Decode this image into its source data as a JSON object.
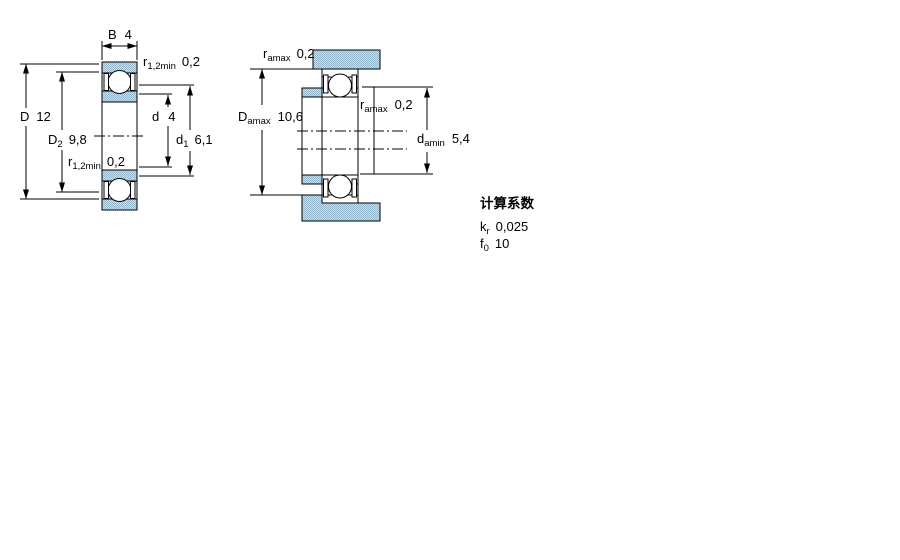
{
  "page": {
    "background": "#ffffff"
  },
  "colors": {
    "line": "#000000",
    "stipple_dark": "#8fb4cc",
    "stipple_light": "#cfe0ec"
  },
  "left_drawing": {
    "description": "bearing-cross-section-with-boundary-dimensions",
    "dims": {
      "B": {
        "symbol": "B",
        "value": "4"
      },
      "r_top": {
        "symbol": "r",
        "sub": "1,2min",
        "value": "0,2"
      },
      "D": {
        "symbol": "D",
        "value": "12"
      },
      "D2": {
        "symbol": "D",
        "sub": "2",
        "value": "9,8"
      },
      "r_mid": {
        "symbol": "r",
        "sub": "1,2min",
        "value": "0,2"
      },
      "d": {
        "symbol": "d",
        "value": "4"
      },
      "d1": {
        "symbol": "d",
        "sub": "1",
        "value": "6,1"
      }
    }
  },
  "right_drawing": {
    "description": "bearing-mounted-abutment-dimensions",
    "dims": {
      "ra_top": {
        "symbol": "r",
        "sub": "amax",
        "value": "0,2"
      },
      "Da": {
        "symbol": "D",
        "sub": "amax",
        "value": "10,6"
      },
      "ra_mid": {
        "symbol": "r",
        "sub": "amax",
        "value": "0,2"
      },
      "da": {
        "symbol": "d",
        "sub": "amin",
        "value": "5,4"
      }
    }
  },
  "calculation_factors": {
    "title": "计算系数",
    "rows": [
      {
        "symbol": "k",
        "sub": "r",
        "value": "0,025"
      },
      {
        "symbol": "f",
        "sub": "0",
        "value": "10"
      }
    ]
  }
}
